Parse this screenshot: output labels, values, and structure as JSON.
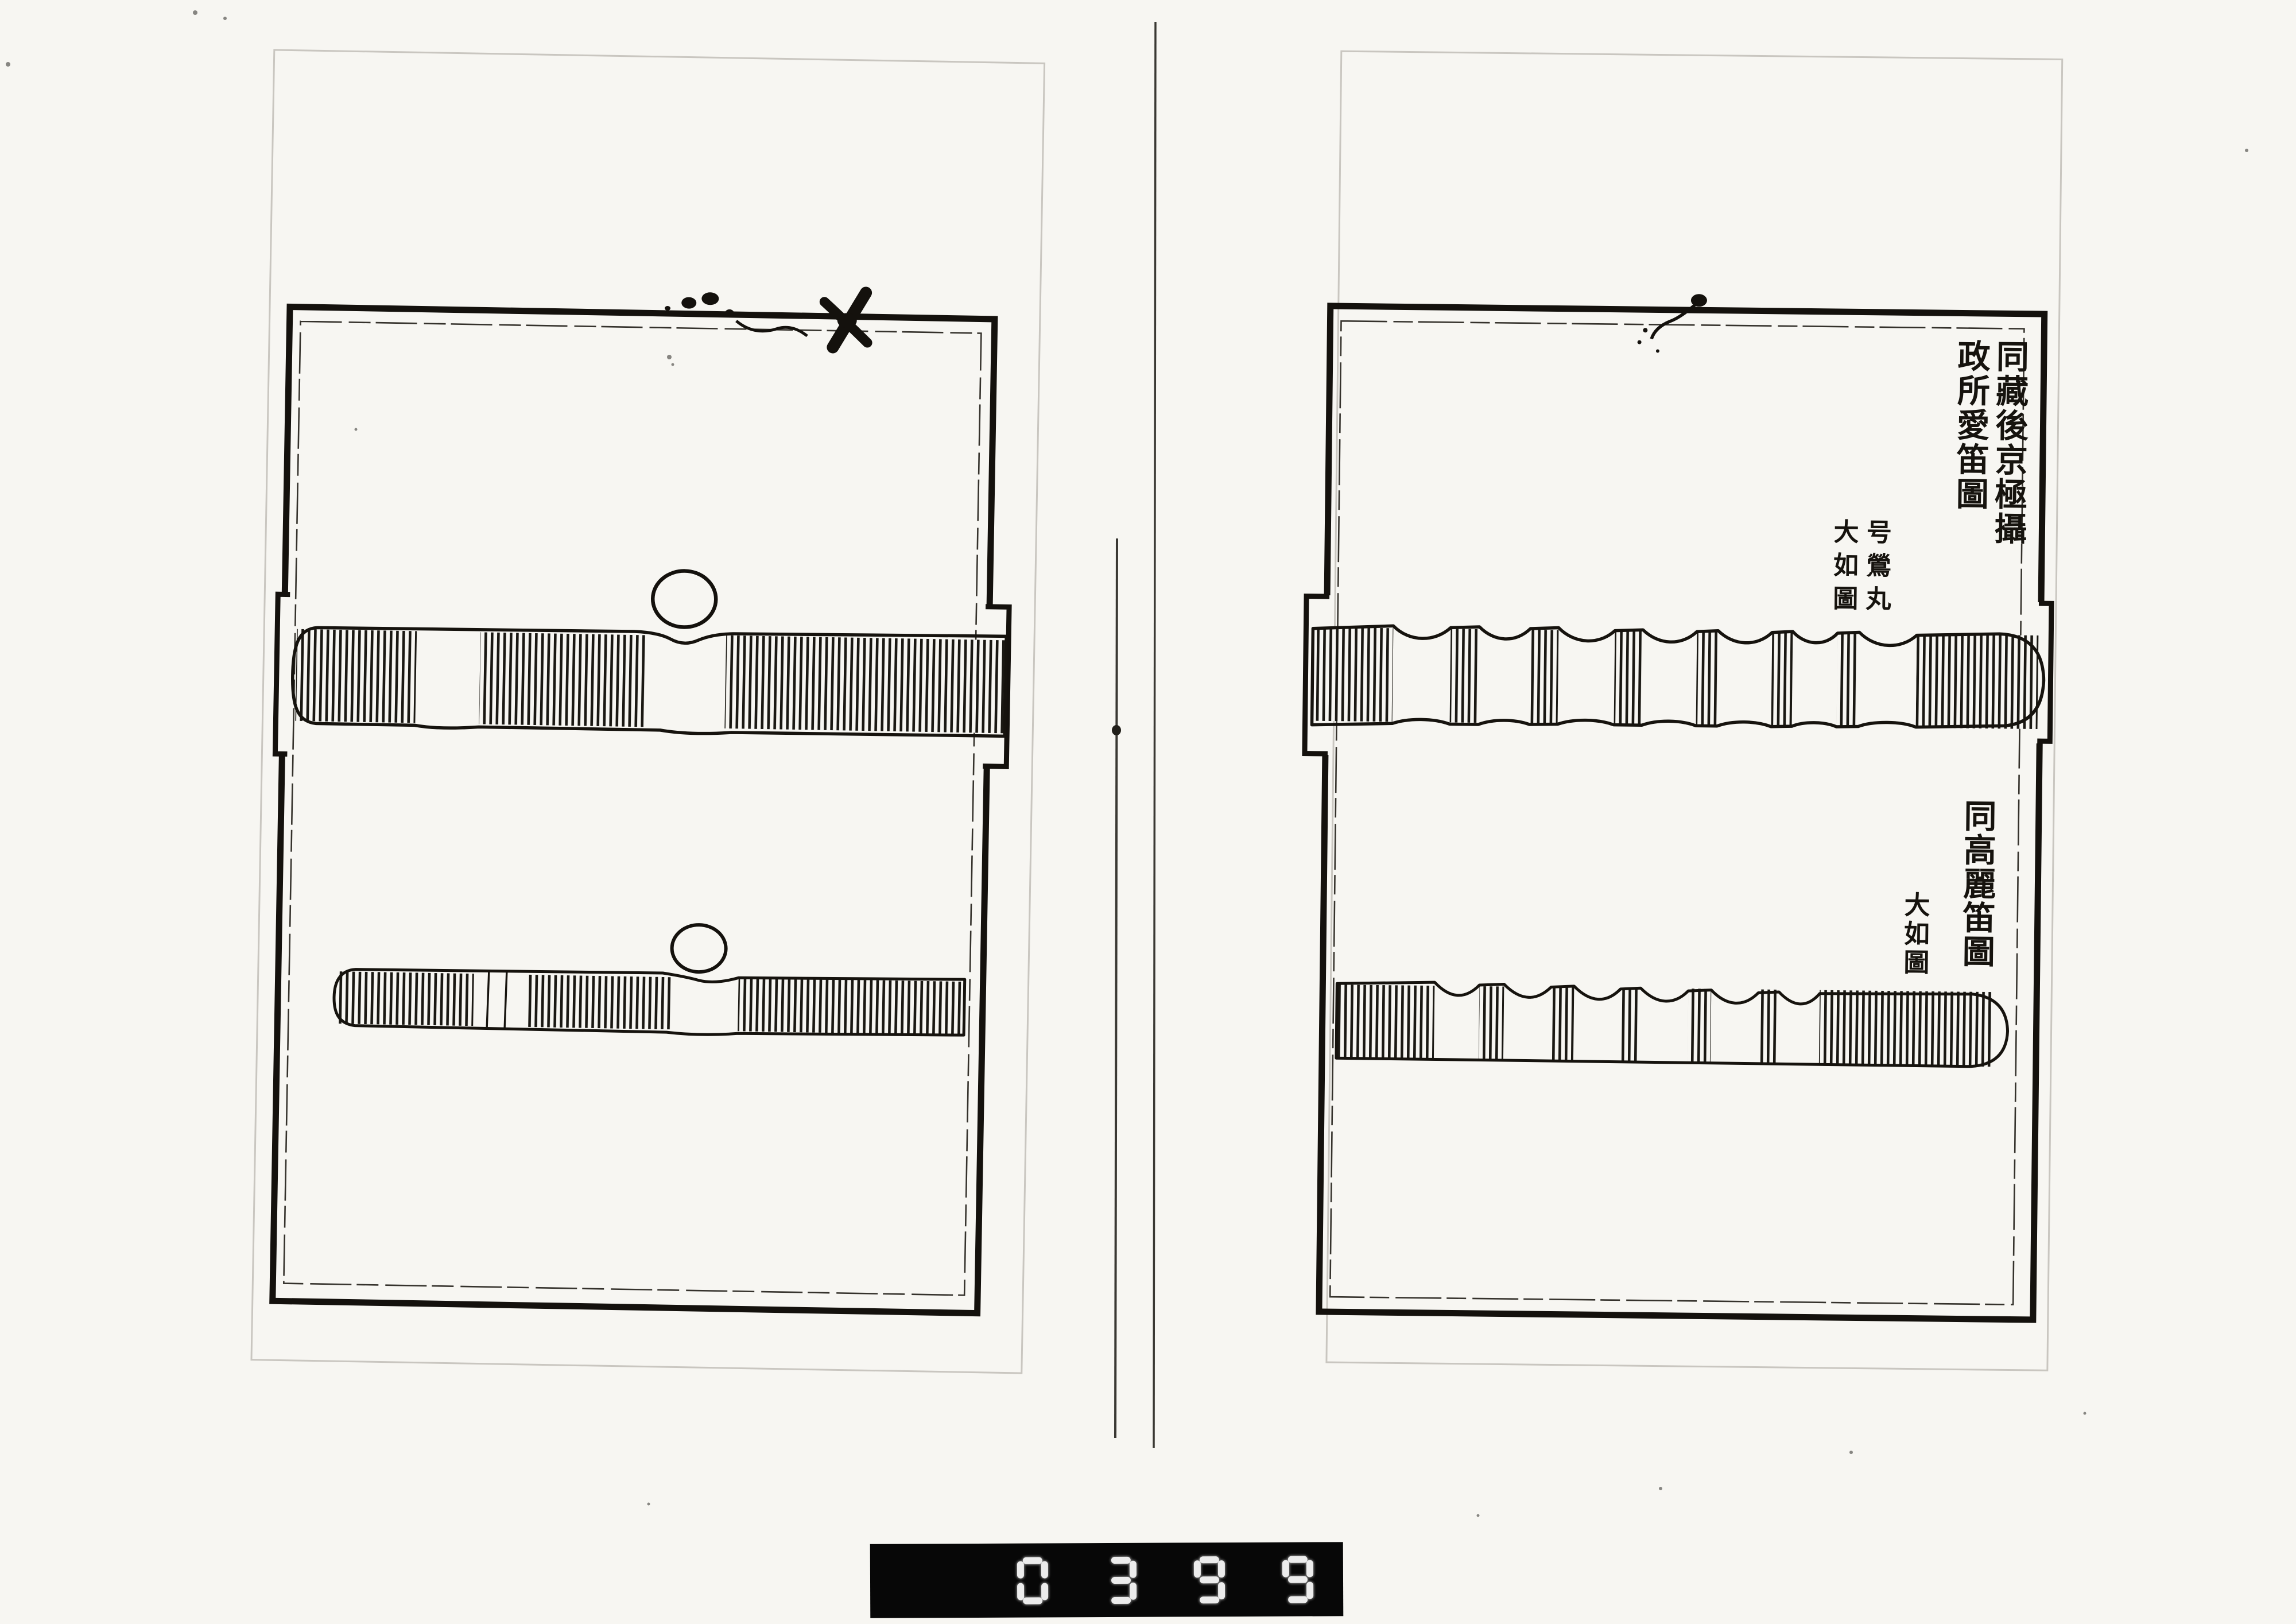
{
  "scan": {
    "background_color": "#f7f6f2",
    "ink_color": "#16130e",
    "pages_visible": 2
  },
  "left_page": {
    "figures": [
      {
        "name": "flute-upper",
        "caption": ""
      },
      {
        "name": "flute-lower",
        "caption": ""
      }
    ]
  },
  "right_page": {
    "caption_top": {
      "col1": "同藏後京極攝",
      "col2": "政所愛笛圖"
    },
    "annotation_top": {
      "col1": "号鶯丸",
      "col2": "大如圖"
    },
    "caption_bottom": "同高麗笛圖",
    "annotation_bottom": "大如圖",
    "figures": [
      {
        "name": "flute-upper-noded"
      },
      {
        "name": "flute-lower-noded"
      }
    ]
  },
  "counter": {
    "digits": "0399"
  }
}
